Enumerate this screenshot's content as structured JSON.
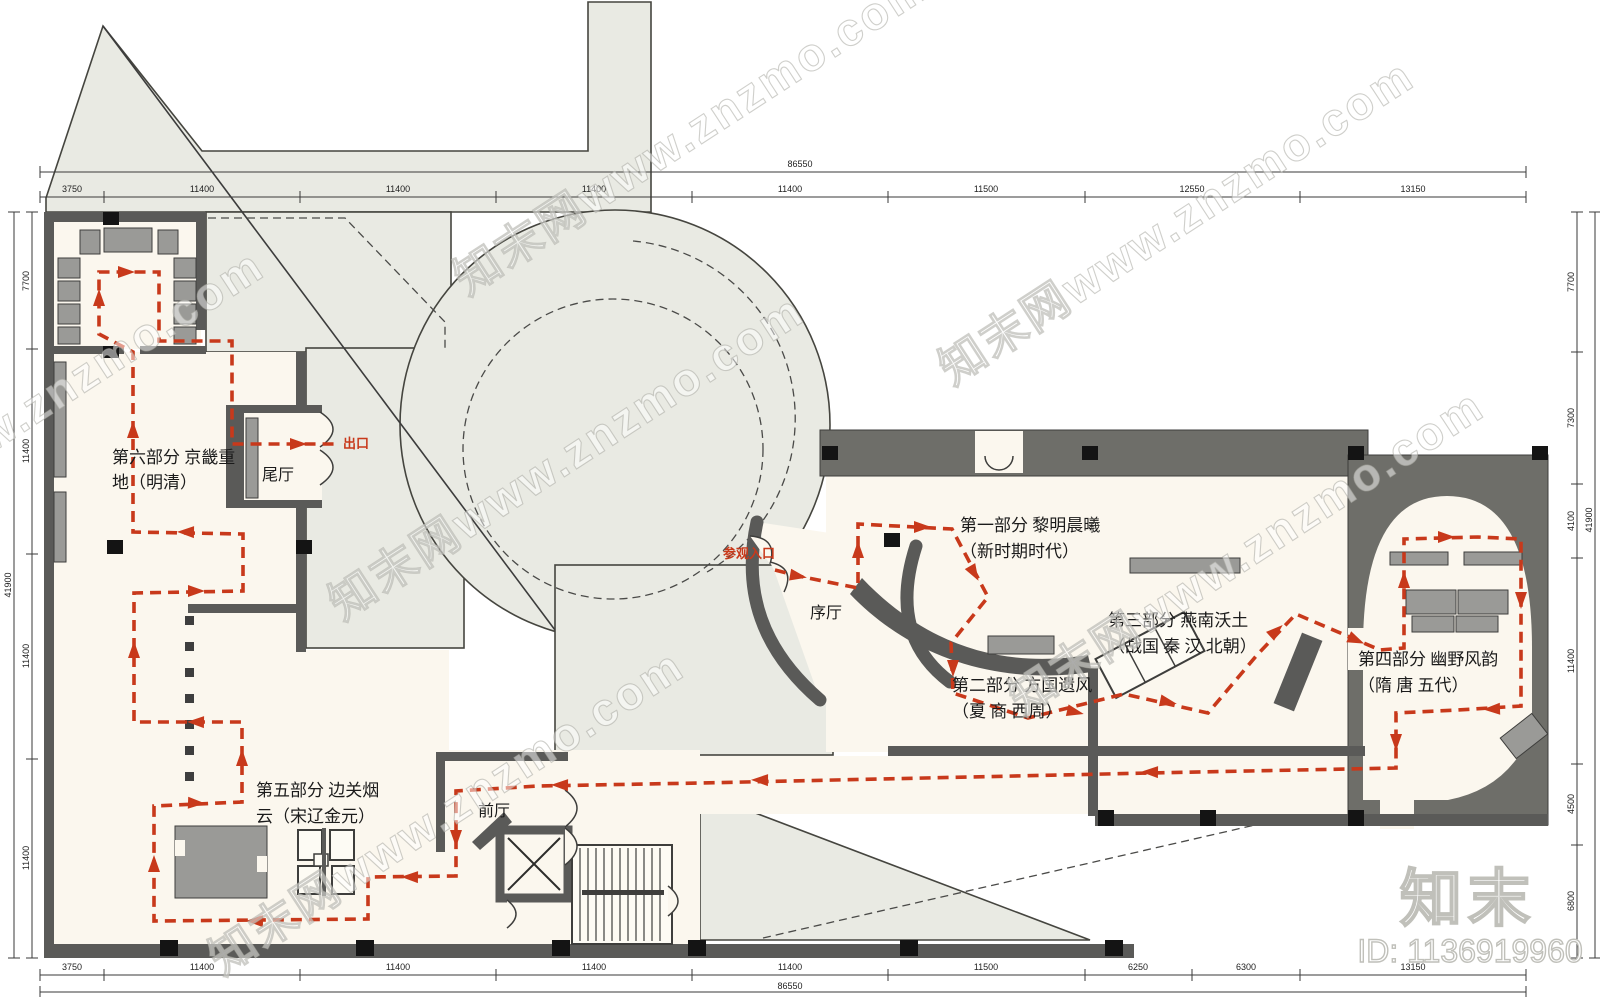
{
  "fp": {
    "entrance": "参观入口",
    "exit": "出口",
    "hall_xu": "序厅",
    "hall_wei": "尾厅",
    "hall_qian": "前厅",
    "p1l1": "第一部分  黎明晨曦",
    "p1l2": "（新时期时代）",
    "p2l1": "第二部分  方国遗风",
    "p2l2": "（夏  商  西周）",
    "p3l1": "第三部分  燕南沃土",
    "p3l2": "（战国  秦  汉  北朝）",
    "p4l1": "第四部分  幽野风韵",
    "p4l2": "（隋  唐  五代）",
    "p5l1": "第五部分  边关烟",
    "p5l2": "云（宋辽金元）",
    "p6l1": "第六部分  京畿重",
    "p6l2": "地（明清）"
  },
  "dims": {
    "top": {
      "overall": "86550",
      "segments": [
        "3750",
        "11400",
        "11400",
        "11400",
        "11400",
        "11500",
        "12550",
        "13150"
      ]
    },
    "bottom": {
      "overall": "86550",
      "segments": [
        "3750",
        "11400",
        "11400",
        "11400",
        "11400",
        "11500",
        "6250",
        "6300",
        "13150"
      ]
    },
    "left": {
      "overall": "41900",
      "segments": [
        "7700",
        "11400",
        "11400",
        "11400"
      ]
    },
    "right": {
      "overall": "41900",
      "segments": [
        "7700",
        "7300",
        "4100",
        "11400",
        "4500",
        "6800"
      ]
    }
  },
  "watermark": {
    "site_text": "知末网www.znzmo.com",
    "logo": "知末",
    "id_text": "ID: 1136919960"
  },
  "colors": {
    "route": "#c8391b",
    "site": "#e9eae3",
    "room": "#fbf7ee",
    "wall": "#5a5a58",
    "poche": "#6e6e69",
    "display": "#9a9a97"
  }
}
